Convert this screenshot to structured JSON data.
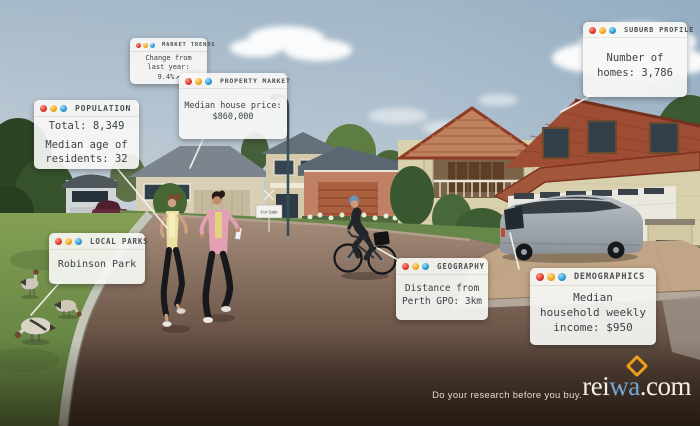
{
  "ad": {
    "tagline": "Do your research before you buy.",
    "logo": {
      "text_white_1": "rei",
      "text_blue": "wa",
      "text_white_2": ".com",
      "blue": "#73a7d4",
      "diamond_orange": "#f09d1a"
    }
  },
  "window_dot_colors": {
    "red": "#e23a30",
    "yellow": "#f4a91f",
    "blue": "#2f9fd6"
  },
  "callouts": {
    "market_trends": {
      "title": "MARKET TRENDS",
      "lines": [
        "Change from",
        "last year: 9.4%"
      ],
      "trend_arrow_icon": "↗"
    },
    "property_market": {
      "title": "PROPERTY MARKET",
      "lines": [
        "Median house price:",
        "$860,000"
      ]
    },
    "suburb_profile": {
      "title": "SUBURB PROFILE",
      "lines": [
        "Number of",
        "homes: 3,786"
      ]
    },
    "population": {
      "title": "POPULATION",
      "lines": [
        "Total: 8,349",
        "Median age of",
        "residents: 32"
      ]
    },
    "local_parks": {
      "title": "LOCAL PARKS",
      "lines": [
        "Robinson Park"
      ]
    },
    "geography": {
      "title": "GEOGRAPHY",
      "lines": [
        "Distance from",
        "Perth GPO: 3km"
      ]
    },
    "demographics": {
      "title": "DEMOGRAPHICS",
      "lines": [
        "Median",
        "household weekly",
        "income: $950"
      ]
    }
  },
  "scene": {
    "sign_text": "For Sale"
  }
}
